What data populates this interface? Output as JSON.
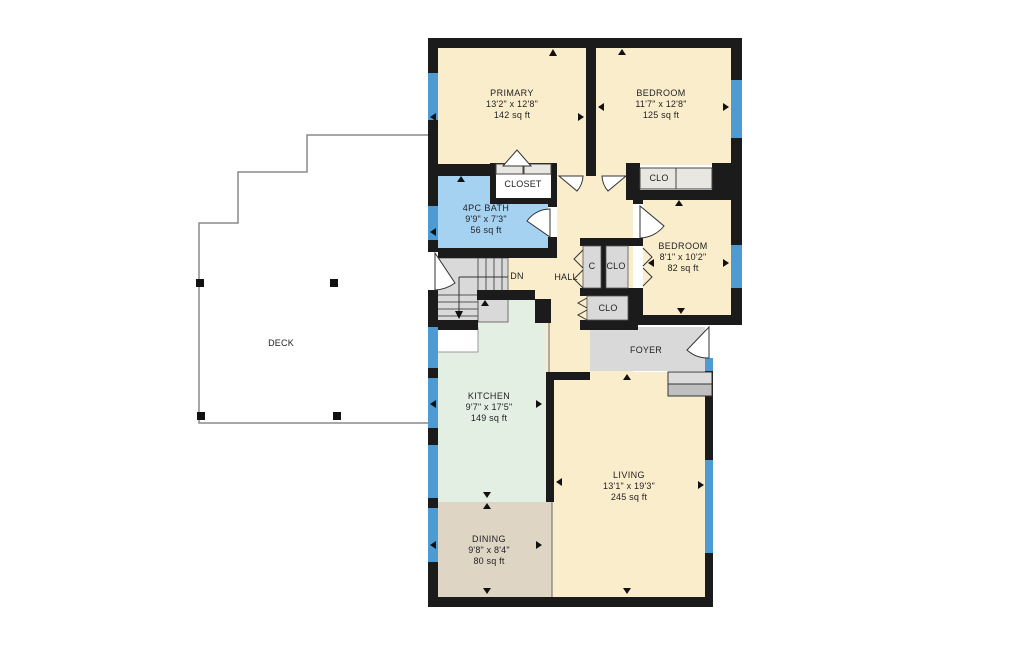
{
  "plan": {
    "type": "residential floor plan",
    "rooms": [
      {
        "id": "primary",
        "name": "PRIMARY",
        "dimensions": "13'2\" x 12'8\"",
        "area": "142 sq ft"
      },
      {
        "id": "bedroom1",
        "name": "BEDROOM",
        "dimensions": "11'7\" x 12'8\"",
        "area": "125 sq ft"
      },
      {
        "id": "bath",
        "name": "4PC BATH",
        "dimensions": "9'9\" x 7'3\"",
        "area": "56 sq ft"
      },
      {
        "id": "bedroom2",
        "name": "BEDROOM",
        "dimensions": "8'1\" x 10'2\"",
        "area": "82 sq ft"
      },
      {
        "id": "kitchen",
        "name": "KITCHEN",
        "dimensions": "9'7\" x 17'5\"",
        "area": "149 sq ft"
      },
      {
        "id": "dining",
        "name": "DINING",
        "dimensions": "9'8\" x 8'4\"",
        "area": "80 sq ft"
      },
      {
        "id": "living",
        "name": "LIVING",
        "dimensions": "13'1\" x 19'3\"",
        "area": "245 sq ft"
      }
    ],
    "labels": {
      "closet_primary": "CLOSET",
      "clo_bedroom1": "CLO",
      "c_hall": "C",
      "clo_hall": "CLO",
      "clo_hall_lower": "CLO",
      "hall": "HALL",
      "foyer": "FOYER",
      "deck": "DECK",
      "stairs_down": "DN"
    },
    "colors": {
      "wall": "#1B1B1B",
      "window": "#4C9CD3",
      "room_cream": "#FAEDCC",
      "bath_blue": "#A6D2F2",
      "kitchen_green": "#E4EFE4",
      "dining_tan": "#DFD5C5",
      "gray_area": "#D9D9D9",
      "closet_panel": "#E9E7E2",
      "deck_line": "#8A8A8A",
      "text": "#1F1F1F"
    }
  }
}
